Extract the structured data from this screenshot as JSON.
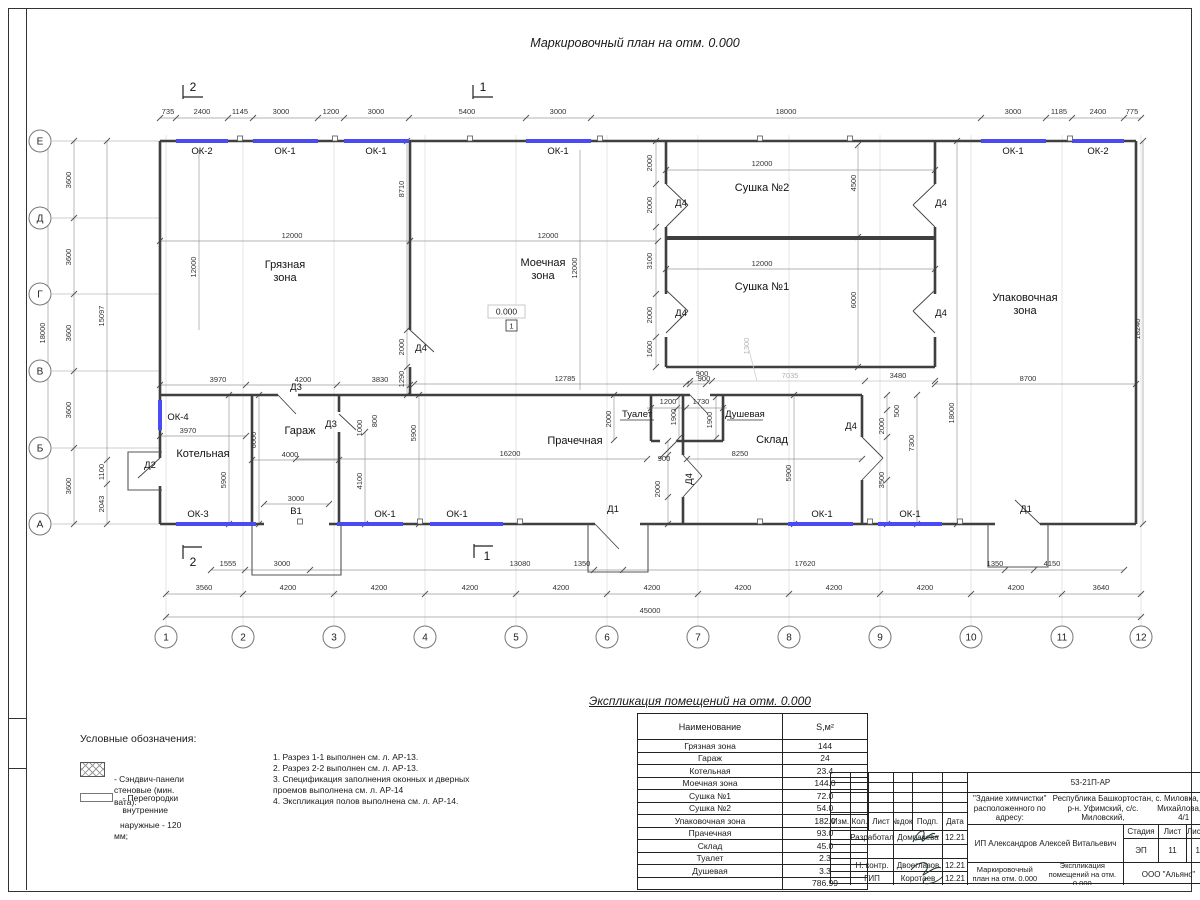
{
  "sheet": {
    "title": "Маркировочный план на отм. 0.000"
  },
  "plan": {
    "axis_rows": [
      "Е",
      "Д",
      "Г",
      "В",
      "Б",
      "А"
    ],
    "axis_cols": [
      "1",
      "2",
      "3",
      "4",
      "5",
      "6",
      "7",
      "8",
      "9",
      "10",
      "11",
      "12"
    ],
    "level_mark": "0.000",
    "level_index": "1",
    "labels": [
      {
        "t": "735",
        "x": 168,
        "y": 114
      },
      {
        "t": "2400",
        "x": 202,
        "y": 114
      },
      {
        "t": "1145",
        "x": 240,
        "y": 114
      },
      {
        "t": "3000",
        "x": 281,
        "y": 114
      },
      {
        "t": "1200",
        "x": 331,
        "y": 114
      },
      {
        "t": "3000",
        "x": 376,
        "y": 114
      },
      {
        "t": "5400",
        "x": 467,
        "y": 114
      },
      {
        "t": "3000",
        "x": 558,
        "y": 114
      },
      {
        "t": "18000",
        "x": 786,
        "y": 114
      },
      {
        "t": "3000",
        "x": 1013,
        "y": 114
      },
      {
        "t": "1185",
        "x": 1059,
        "y": 114
      },
      {
        "t": "2400",
        "x": 1098,
        "y": 114
      },
      {
        "t": "775",
        "x": 1132,
        "y": 114
      },
      {
        "t": "ОК-2",
        "x": 202,
        "y": 154,
        "c": "open"
      },
      {
        "t": "ОК-1",
        "x": 285,
        "y": 154,
        "c": "open"
      },
      {
        "t": "ОК-1",
        "x": 376,
        "y": 154,
        "c": "open"
      },
      {
        "t": "ОК-1",
        "x": 558,
        "y": 154,
        "c": "open"
      },
      {
        "t": "ОК-1",
        "x": 1013,
        "y": 154,
        "c": "open"
      },
      {
        "t": "ОК-2",
        "x": 1098,
        "y": 154,
        "c": "open"
      },
      {
        "t": "2",
        "x": 193,
        "y": 91,
        "c": "sec"
      },
      {
        "t": "1",
        "x": 483,
        "y": 91,
        "c": "sec"
      },
      {
        "t": "2",
        "x": 193,
        "y": 566,
        "c": "sec"
      },
      {
        "t": "1",
        "x": 487,
        "y": 560,
        "c": "sec"
      },
      {
        "t": "18000",
        "x": 45,
        "y": 333,
        "r": 1
      },
      {
        "t": "3600",
        "x": 71,
        "y": 180,
        "r": 1
      },
      {
        "t": "3600",
        "x": 71,
        "y": 257,
        "r": 1
      },
      {
        "t": "3600",
        "x": 71,
        "y": 333,
        "r": 1
      },
      {
        "t": "3600",
        "x": 71,
        "y": 410,
        "r": 1
      },
      {
        "t": "3600",
        "x": 71,
        "y": 486,
        "r": 1
      },
      {
        "t": "15097",
        "x": 104,
        "y": 316,
        "r": 1
      },
      {
        "t": "1100",
        "x": 104,
        "y": 472,
        "r": 1
      },
      {
        "t": "2043",
        "x": 104,
        "y": 504,
        "r": 1
      },
      {
        "t": "1555",
        "x": 228,
        "y": 566
      },
      {
        "t": "3000",
        "x": 282,
        "y": 566
      },
      {
        "t": "13080",
        "x": 520,
        "y": 566
      },
      {
        "t": "1350",
        "x": 582,
        "y": 566
      },
      {
        "t": "17620",
        "x": 805,
        "y": 566
      },
      {
        "t": "1350",
        "x": 995,
        "y": 566
      },
      {
        "t": "4150",
        "x": 1052,
        "y": 566
      },
      {
        "t": "3560",
        "x": 204,
        "y": 590
      },
      {
        "t": "4200",
        "x": 288,
        "y": 590
      },
      {
        "t": "4200",
        "x": 379,
        "y": 590
      },
      {
        "t": "4200",
        "x": 470,
        "y": 590
      },
      {
        "t": "4200",
        "x": 561,
        "y": 590
      },
      {
        "t": "4200",
        "x": 652,
        "y": 590
      },
      {
        "t": "4200",
        "x": 743,
        "y": 590
      },
      {
        "t": "4200",
        "x": 834,
        "y": 590
      },
      {
        "t": "4200",
        "x": 925,
        "y": 590
      },
      {
        "t": "4200",
        "x": 1016,
        "y": 590
      },
      {
        "t": "3640",
        "x": 1101,
        "y": 590
      },
      {
        "t": "45000",
        "x": 650,
        "y": 613
      },
      {
        "t": "Грязная",
        "x": 285,
        "y": 268,
        "c": "room"
      },
      {
        "t": "зона",
        "x": 285,
        "y": 281,
        "c": "room"
      },
      {
        "t": "12000",
        "x": 292,
        "y": 238
      },
      {
        "t": "12000",
        "x": 196,
        "y": 267,
        "r": 1
      },
      {
        "t": "8710",
        "x": 404,
        "y": 189,
        "r": 1
      },
      {
        "t": "2000",
        "x": 404,
        "y": 347,
        "r": 1
      },
      {
        "t": "Д4",
        "x": 421,
        "y": 351,
        "c": "open"
      },
      {
        "t": "1290",
        "x": 404,
        "y": 379,
        "r": 1
      },
      {
        "t": "3970",
        "x": 218,
        "y": 382
      },
      {
        "t": "4200",
        "x": 303,
        "y": 382
      },
      {
        "t": "3830",
        "x": 380,
        "y": 382
      },
      {
        "t": "Моечная",
        "x": 543,
        "y": 266,
        "c": "room"
      },
      {
        "t": "зона",
        "x": 543,
        "y": 279,
        "c": "room"
      },
      {
        "t": "12000",
        "x": 548,
        "y": 238
      },
      {
        "t": "12000",
        "x": 577,
        "y": 268,
        "r": 1
      },
      {
        "t": "12785",
        "x": 565,
        "y": 381
      },
      {
        "t": "Сушка №2",
        "x": 762,
        "y": 191,
        "c": "room"
      },
      {
        "t": "12000",
        "x": 762,
        "y": 166
      },
      {
        "t": "4500",
        "x": 856,
        "y": 183,
        "r": 1
      },
      {
        "t": "Сушка №1",
        "x": 762,
        "y": 290,
        "c": "room"
      },
      {
        "t": "12000",
        "x": 762,
        "y": 266
      },
      {
        "t": "6000",
        "x": 856,
        "y": 300,
        "r": 1
      },
      {
        "t": "Д4",
        "x": 681,
        "y": 206,
        "c": "open"
      },
      {
        "t": "Д4",
        "x": 941,
        "y": 206,
        "c": "open"
      },
      {
        "t": "Д4",
        "x": 681,
        "y": 316,
        "c": "open"
      },
      {
        "t": "Д4",
        "x": 941,
        "y": 316,
        "c": "open"
      },
      {
        "t": "2000",
        "x": 652,
        "y": 163,
        "r": 1
      },
      {
        "t": "2000",
        "x": 652,
        "y": 205,
        "r": 1
      },
      {
        "t": "3100",
        "x": 652,
        "y": 261,
        "r": 1
      },
      {
        "t": "2000",
        "x": 652,
        "y": 315,
        "r": 1
      },
      {
        "t": "1600",
        "x": 652,
        "y": 349,
        "r": 1
      },
      {
        "t": "900",
        "x": 702,
        "y": 376
      },
      {
        "t": "7035",
        "x": 790,
        "y": 378,
        "c": "grey"
      },
      {
        "t": "3480",
        "x": 898,
        "y": 378
      },
      {
        "t": "1300",
        "x": 749,
        "y": 346,
        "r": 1,
        "c": "grey"
      },
      {
        "t": "Упаковочная",
        "x": 1025,
        "y": 301,
        "c": "room"
      },
      {
        "t": "зона",
        "x": 1025,
        "y": 314,
        "c": "room"
      },
      {
        "t": "8700",
        "x": 1028,
        "y": 381
      },
      {
        "t": "18240",
        "x": 1140,
        "y": 329,
        "r": 1
      },
      {
        "t": "18000",
        "x": 954,
        "y": 413,
        "r": 1
      },
      {
        "t": "7300",
        "x": 914,
        "y": 443,
        "r": 1
      },
      {
        "t": "ОК-4",
        "x": 178,
        "y": 420,
        "c": "open"
      },
      {
        "t": "3970",
        "x": 188,
        "y": 433
      },
      {
        "t": "Котельная",
        "x": 203,
        "y": 457,
        "c": "room"
      },
      {
        "t": "5900",
        "x": 226,
        "y": 480,
        "r": 1
      },
      {
        "t": "Д2",
        "x": 150,
        "y": 468,
        "c": "open"
      },
      {
        "t": "ОК-3",
        "x": 198,
        "y": 517,
        "c": "open"
      },
      {
        "t": "Д3",
        "x": 296,
        "y": 390,
        "c": "open"
      },
      {
        "t": "Д3",
        "x": 331,
        "y": 427,
        "c": "open"
      },
      {
        "t": "Гараж",
        "x": 300,
        "y": 434,
        "c": "room"
      },
      {
        "t": "4000",
        "x": 290,
        "y": 457
      },
      {
        "t": "6000",
        "x": 256,
        "y": 440,
        "r": 1
      },
      {
        "t": "1000",
        "x": 362,
        "y": 428,
        "r": 1
      },
      {
        "t": "800",
        "x": 377,
        "y": 421,
        "r": 1
      },
      {
        "t": "5900",
        "x": 416,
        "y": 433,
        "r": 1
      },
      {
        "t": "4100",
        "x": 362,
        "y": 481,
        "r": 1
      },
      {
        "t": "3000",
        "x": 296,
        "y": 501
      },
      {
        "t": "В1",
        "x": 296,
        "y": 514,
        "c": "open"
      },
      {
        "t": "ОК-1",
        "x": 385,
        "y": 517,
        "c": "open"
      },
      {
        "t": "ОК-1",
        "x": 457,
        "y": 517,
        "c": "open"
      },
      {
        "t": "Прачечная",
        "x": 575,
        "y": 444,
        "c": "room"
      },
      {
        "t": "16200",
        "x": 510,
        "y": 456
      },
      {
        "t": "2000",
        "x": 611,
        "y": 419,
        "r": 1
      },
      {
        "t": "Туалет",
        "x": 637,
        "y": 417,
        "c": "open"
      },
      {
        "t": "1200",
        "x": 668,
        "y": 404
      },
      {
        "t": "1900",
        "x": 676,
        "y": 417,
        "r": 1
      },
      {
        "t": "1730",
        "x": 701,
        "y": 404
      },
      {
        "t": "1900",
        "x": 712,
        "y": 420,
        "r": 1
      },
      {
        "t": "Душевая",
        "x": 745,
        "y": 417,
        "c": "open"
      },
      {
        "t": "900",
        "x": 704,
        "y": 381
      },
      {
        "t": "900",
        "x": 664,
        "y": 461
      },
      {
        "t": "2000",
        "x": 660,
        "y": 489,
        "r": 1
      },
      {
        "t": "Д4",
        "x": 692,
        "y": 479,
        "r": 1,
        "c": "open"
      },
      {
        "t": "Д1",
        "x": 613,
        "y": 512,
        "c": "open"
      },
      {
        "t": "ОК-1",
        "x": 822,
        "y": 517,
        "c": "open"
      },
      {
        "t": "ОК-1",
        "x": 910,
        "y": 517,
        "c": "open"
      },
      {
        "t": "Склад",
        "x": 772,
        "y": 443,
        "c": "room"
      },
      {
        "t": "8250",
        "x": 740,
        "y": 456
      },
      {
        "t": "Д4",
        "x": 851,
        "y": 429,
        "c": "open"
      },
      {
        "t": "500",
        "x": 899,
        "y": 411,
        "r": 1
      },
      {
        "t": "2000",
        "x": 884,
        "y": 426,
        "r": 1
      },
      {
        "t": "3500",
        "x": 884,
        "y": 480,
        "r": 1
      },
      {
        "t": "5900",
        "x": 791,
        "y": 473,
        "r": 1
      },
      {
        "t": "Д1",
        "x": 1026,
        "y": 512,
        "c": "open"
      }
    ]
  },
  "legend": {
    "title": "Условные обозначения:",
    "item1_line1": "- Сэндвич-панели стеновые (мин. вата):",
    "item1_line2": "наружные - 120 мм;",
    "item2": "- Перегородки внутренние"
  },
  "notes": [
    "1. Разрез 1-1 выполнен см. л. АР-13.",
    "2. Разрез 2-2 выполнен см. л. АР-13.",
    "3. Спецификация заполнения оконных и дверных",
    "проемов выполнена см. л. АР-14",
    "4. Экспликация полов выполнена см. л. АР-14."
  ],
  "table": {
    "title": "Экспликация помещений на отм. 0.000",
    "headers": [
      "Наименование",
      "S,м²"
    ],
    "rows": [
      [
        "Грязная зона",
        "144"
      ],
      [
        "Гараж",
        "24"
      ],
      [
        "Котельная",
        "23.4"
      ],
      [
        "Моечная зона",
        "144.0"
      ],
      [
        "Сушка №1",
        "72.0"
      ],
      [
        "Сушка №2",
        "54.0"
      ],
      [
        "Упаковочная зона",
        "182.0"
      ],
      [
        "Прачечная",
        "93.0"
      ],
      [
        "Склад",
        "45.0"
      ],
      [
        "Туалет",
        "2.3"
      ],
      [
        "Душевая",
        "3.3"
      ]
    ],
    "total": "786.99"
  },
  "titleblock": {
    "doc_number": "53-21П-АР",
    "addr1": "\"Здание химчистки\" расположенного по адресу:",
    "addr2": "Республика Башкортостан, р-н. Уфимский, с/с. Миловский,",
    "addr3": "с. Миловка, ул. Михайлова, д. 4/1",
    "cols": [
      "Изм.",
      "Кол.",
      "Лист",
      "№док.",
      "Подп.",
      "Дата"
    ],
    "row1_role": "Разработал",
    "row1_name": "Домрачева",
    "row1_date": "12.21",
    "row2_role": "Н. контр.",
    "row2_name": "Двоеглазов",
    "row2_date": "12.21",
    "row3_role": "ГИП",
    "row3_name": "Коротаев",
    "row3_date": "12.21",
    "client": "ИП Александров Алексей Витальевич",
    "stage_h": "Стадия",
    "sheet_h": "Лист",
    "sheets_h": "Листов",
    "stage": "ЭП",
    "sheet_no": "11",
    "sheets_no": "14",
    "sheet_title1": "Маркировочный план на отм. 0.000",
    "sheet_title2": "Экспликация помещений на отм. 0.000",
    "company": "ООО \"Альянс\""
  }
}
